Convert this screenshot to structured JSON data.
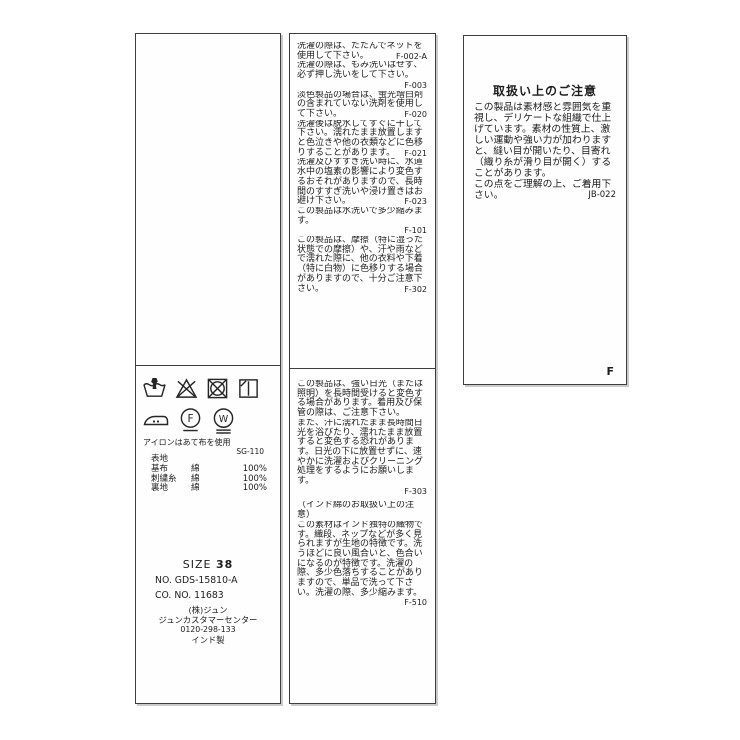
{
  "colors": {
    "ink": "#1c1c1c",
    "border": "#3e3e3e",
    "background": "#ffffff"
  },
  "care_label": {
    "left_panel": {
      "symbols": [
        "hand-wash",
        "do-not-bleach",
        "do-not-tumble-dry",
        "line-dry-in-shade",
        "iron-medium-with-cloth",
        "dry-clean-petroleum-gentle",
        "wet-clean-very-gentle"
      ],
      "iron_note": "アイロンはあて布を使用",
      "code": "SG-110",
      "composition_header": "表地",
      "composition_rows": [
        {
          "part": "基布",
          "material": "綿",
          "percent": "100%"
        },
        {
          "part": "刺繍糸",
          "material": "綿",
          "percent": "100%"
        },
        {
          "part": "裏地",
          "material": "綿",
          "percent": "100%"
        }
      ],
      "size_label": "SIZE",
      "size_value": "38",
      "item_no": "NO. GDS-15810-A",
      "co_no": "CO. NO. 11683",
      "company": "(株)ジュン",
      "support": "ジュンカスタマーセンター",
      "phone": "0120-298-133",
      "origin": "インド製"
    },
    "middle_panel": {
      "block1": [
        {
          "text": "洗濯の際は、たたんでネットを使用して下さい。",
          "code": "F-002-A"
        },
        {
          "text": "洗濯の際は、もみ洗いはせず、必ず押し洗いをして下さい。",
          "code": ""
        },
        {
          "text": "",
          "code": "F-003"
        },
        {
          "text": "淡色製品の場合は、蛍光増白剤の含まれていない洗剤を使用して下さい。",
          "code": "F-020"
        },
        {
          "text": "洗濯後は脱水してすぐに干して下さい。濡れたまま放置しますと色泣きや他の衣類などに色移りすることがあります。",
          "code": "F-021"
        },
        {
          "text": "洗濯及びすすぎ洗い時に、水道水中の塩素の影響により変色するおそれがありますので、長時間のすすぎ洗いや浸け置きはお避け下さい。",
          "code": "F-023"
        },
        {
          "text": "この製品は水洗いで多少縮みます。",
          "code": ""
        },
        {
          "text": "",
          "code": "F-101"
        },
        {
          "text": "この製品は、摩擦（特に湿った状態での摩擦）や、汗や雨などで濡れた際に、他の衣料や下着（特に白物）に色移りする場合がありますので、十分ご注意下さい。",
          "code": "F-302"
        }
      ],
      "block2": [
        {
          "text": "この製品は、強い日光（または照明）を長時間受けると変色する場合があります。着用及び保管の際は、ご注意下さい。",
          "code": ""
        },
        {
          "text": "また、汗に濡れたまま長時間日光を浴びたり、濡れたまま放置すると変色する恐れがあります。日光の下に放置せずに、速やかに洗濯およびクリーニング処理をするようにお願いします。",
          "code": ""
        },
        {
          "text": "",
          "code": "F-303"
        },
        {
          "text": "（インド綿のお取扱い上の注意）",
          "code": ""
        },
        {
          "text": "この素材はインド独特の織物です。織段、ネップなどが多く見られますが生地の特徴です。洗うほどに良い風合いと、色合いになるのが特徴です。洗濯の際、多少色落ちすることがありますので、単品で洗って下さい。洗濯の際、多少縮みます。",
          "code": "F-510"
        }
      ]
    },
    "right_panel": {
      "title": "取扱い上のご注意",
      "paragraphs": [
        {
          "text": "この製品は素材感と雰囲気を重視し、デリケートな組織で仕上げています。素材の性質上、激しい運動や強い力が加わりますと、縫い目が開いたり、目寄れ（織り糸が滑り目が開く）することがあります。",
          "code": ""
        },
        {
          "text": "この点をご理解の上、ご着用下さい。",
          "code": "JB-022"
        }
      ],
      "corner_mark": "F"
    }
  }
}
